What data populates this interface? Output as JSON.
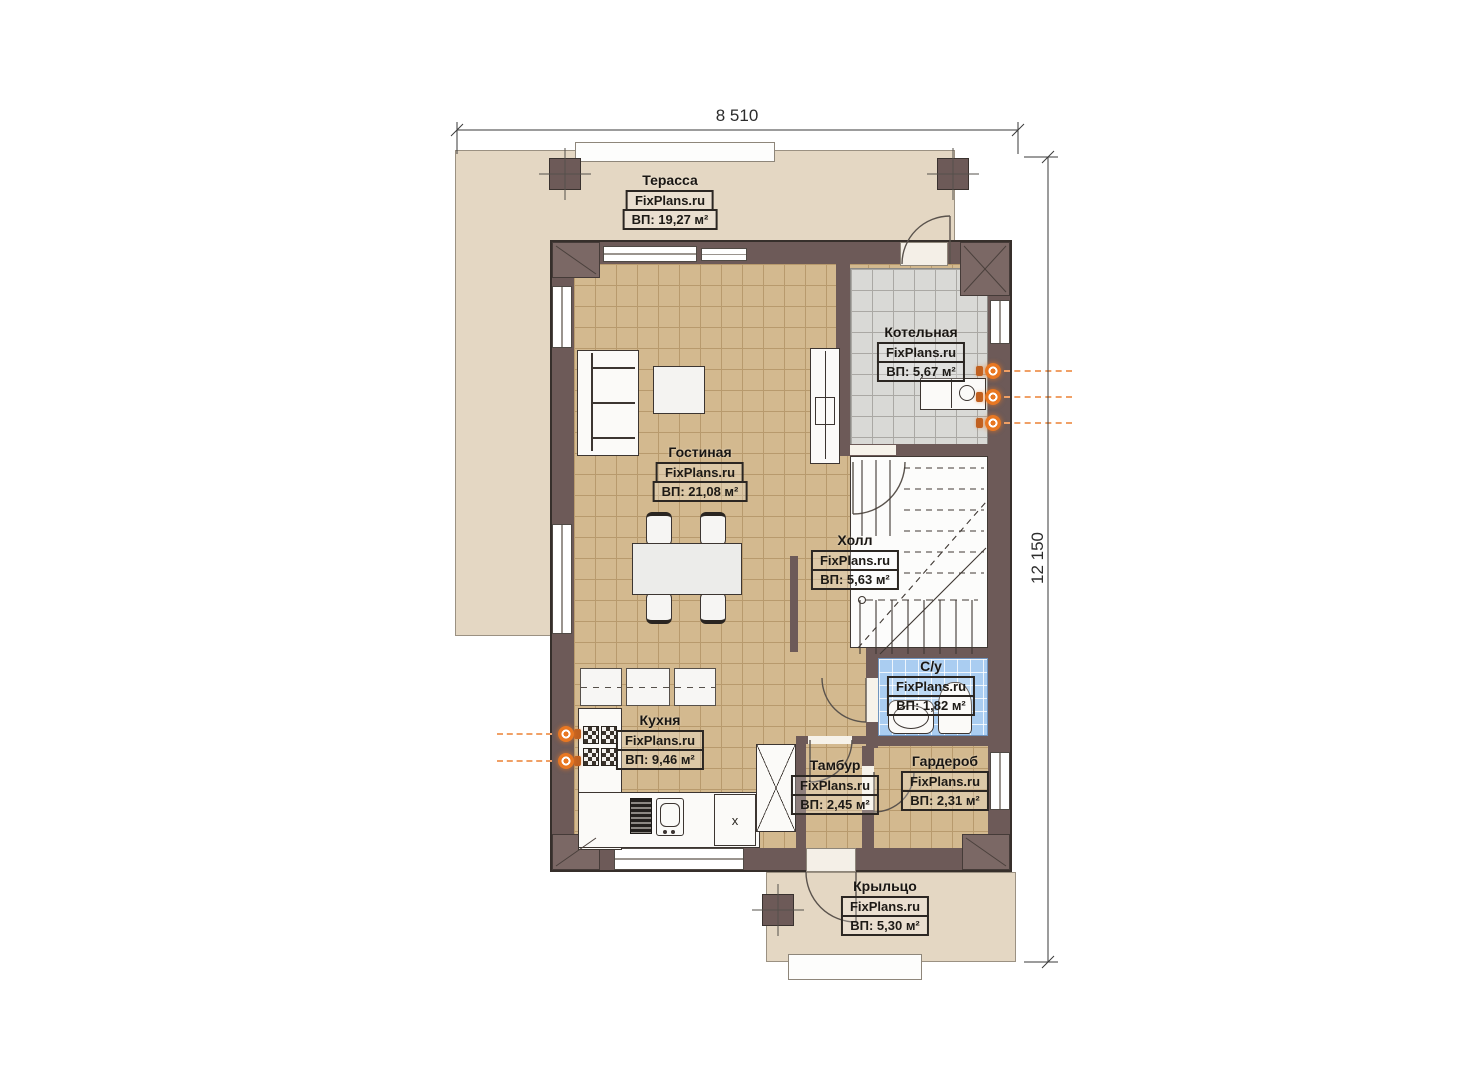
{
  "title": "План первого этажа",
  "dimensions": {
    "width_label": "8 510",
    "height_label": "12 150"
  },
  "rooms": [
    {
      "id": "terrace",
      "name": "Терасса",
      "brand": "FixPlans.ru",
      "area": "ВП: 19,27 м²"
    },
    {
      "id": "boiler",
      "name": "Котельная",
      "brand": "FixPlans.ru",
      "area": "ВП: 5,67 м²"
    },
    {
      "id": "living",
      "name": "Гостиная",
      "brand": "FixPlans.ru",
      "area": "ВП: 21,08 м²"
    },
    {
      "id": "hall",
      "name": "Холл",
      "brand": "FixPlans.ru",
      "area": "ВП: 5,63 м²"
    },
    {
      "id": "bathroom",
      "name": "С/у",
      "brand": "FixPlans.ru",
      "area": "ВП: 1,82 м²"
    },
    {
      "id": "kitchen",
      "name": "Кухня",
      "brand": "FixPlans.ru",
      "area": "ВП: 9,46 м²"
    },
    {
      "id": "vestibule",
      "name": "Тамбур",
      "brand": "FixPlans.ru",
      "area": "ВП: 2,45 м²"
    },
    {
      "id": "wardrobe",
      "name": "Гардероб",
      "brand": "FixPlans.ru",
      "area": "ВП: 2,31 м²"
    },
    {
      "id": "porch",
      "name": "Крыльцо",
      "brand": "FixPlans.ru",
      "area": "ВП: 5,30 м²"
    }
  ],
  "annotations": {
    "kitchen_unit_x": "x"
  },
  "colors": {
    "wall": "#6d5a58",
    "terrace_fill": "#e4d7c3",
    "floor_tan": "#d3b98f",
    "floor_gray": "#d9d9d6",
    "floor_blue": "#aacdf1",
    "accent_orange": "#e87722"
  }
}
